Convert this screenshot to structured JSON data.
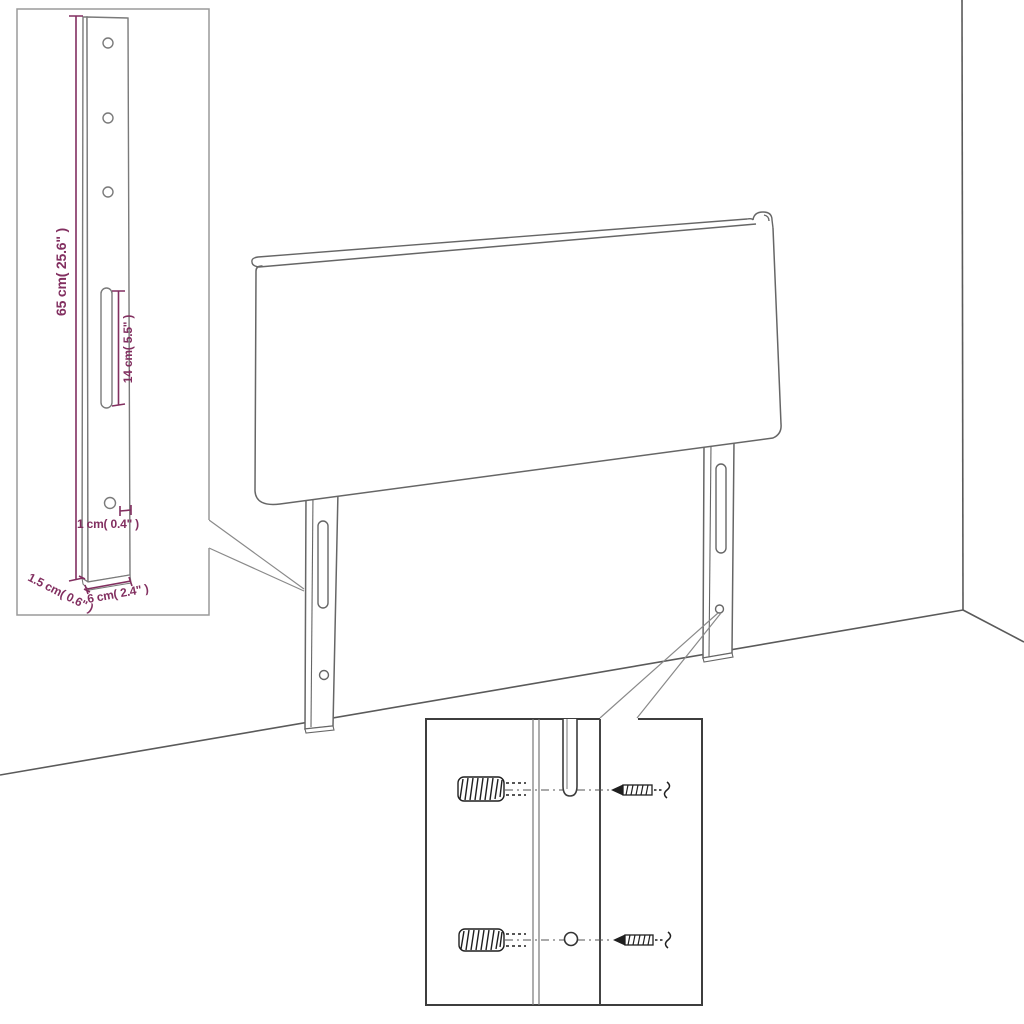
{
  "diagram": {
    "subject": "headboard-with-mounting-legs-dimension-diagram",
    "dimension_labels": {
      "leg_height": "65 cm( 25.6\" )",
      "slot_length": "14 cm( 5.5\" )",
      "hole_size": "1 cm( 0.4\" )",
      "leg_thickness": "1.5 cm( 0.6\" )",
      "leg_width": "6 cm( 2.4\" )"
    },
    "colors": {
      "dimension_accent": "#822f60",
      "drawing_line": "#666666",
      "inset_border": "#9a9a9a",
      "detail_border": "#3d3d3d"
    }
  }
}
